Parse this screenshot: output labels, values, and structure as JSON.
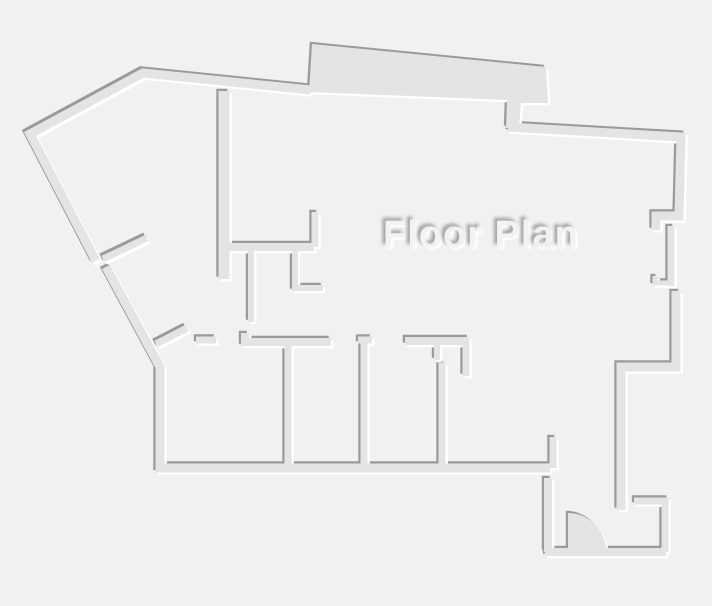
{
  "title": "Floor Plan",
  "drawing": {
    "canvas": {
      "width": 712,
      "height": 606
    },
    "colors": {
      "background": "#f0f1f1",
      "wall": "#e3e5e5",
      "shadow": "#9a9a9a",
      "highlight": "#ffffff",
      "title_fill": "#f1f2f2"
    },
    "effects": {
      "shadow_offset": -2.2,
      "highlight_offset": 2.4
    },
    "title_position": {
      "left": 383,
      "top": 214,
      "font_size": 38
    },
    "shapes": [
      {
        "name": "outer-wall-top-left",
        "d": "M311,90 L143,73 L30,134 L96,261",
        "width": 9
      },
      {
        "name": "outer-wall-left-lower",
        "d": "M106,267 L160,367 L160,468 L550,468",
        "width": 9
      },
      {
        "name": "top-bay-slab",
        "d": "M309,92 L312,44 L546,67 L548,103 L521,103 L519,127 L506,128 L507,100 Z",
        "fill": true
      },
      {
        "name": "outer-wall-top-right",
        "d": "M508,127 L681,137 L679,216 L656,216 L656,230",
        "width": 9
      },
      {
        "name": "right-window-inner-wall",
        "d": "M671,226 L671,286",
        "width": 7
      },
      {
        "name": "right-window-jamb",
        "d": "M655,276 L655,283 L672,283",
        "width": 5
      },
      {
        "name": "outer-wall-right-lower",
        "d": "M676,291 L676,367 L621,367 L621,510",
        "width": 9
      },
      {
        "name": "entry-alcove-wall",
        "d": "M634,501 L665,501 L665,552",
        "width": 7
      },
      {
        "name": "entry-bottom-wall",
        "d": "M545,552 L666,552",
        "width": 8
      },
      {
        "name": "entry-left-wall",
        "d": "M548,478 L548,552",
        "width": 8
      },
      {
        "name": "entry-stub-wall",
        "d": "M553,437 L553,468",
        "width": 7
      },
      {
        "name": "entry-door-swing",
        "d": "M568,551 L568,513 A38,38 0 0 1 606,551 Z",
        "fill": true
      },
      {
        "name": "left-partition-stub",
        "d": "M103,259 L147,238",
        "width": 7
      },
      {
        "name": "diagonal-partition",
        "d": "M156,344 L187,328",
        "width": 7
      },
      {
        "name": "diagonal-partition-stub",
        "d": "M196,340 L216,340",
        "width": 7
      },
      {
        "name": "room1-top-wall",
        "d": "M245,333 L245,342 L331,342",
        "width": 8
      },
      {
        "name": "room-divider-1",
        "d": "M288,342 L288,468",
        "width": 7
      },
      {
        "name": "room2-door-jamb",
        "d": "M358,340 L372,340",
        "width": 7
      },
      {
        "name": "room-divider-2",
        "d": "M364,340 L364,468",
        "width": 7
      },
      {
        "name": "room3-top-wall",
        "d": "M405,341 L469,341",
        "width": 8
      },
      {
        "name": "room3-top-stub",
        "d": "M437,341 L437,360",
        "width": 6
      },
      {
        "name": "room3-right-jamb",
        "d": "M466,341 L466,376",
        "width": 7
      },
      {
        "name": "room-divider-3",
        "d": "M442,363 L442,468",
        "width": 7
      },
      {
        "name": "interior-vertical-wall",
        "d": "M224,91 L224,279",
        "width": 11
      },
      {
        "name": "interior-horizontal-wall",
        "d": "M224,247 L314,247",
        "width": 8
      },
      {
        "name": "interior-upper-stub",
        "d": "M315,212 L315,247",
        "width": 7
      },
      {
        "name": "interior-lower-stub",
        "d": "M251,250 L251,322",
        "width": 6
      },
      {
        "name": "interior-l-wall",
        "d": "M295,250 L295,288 L323,288",
        "width": 6
      }
    ]
  }
}
